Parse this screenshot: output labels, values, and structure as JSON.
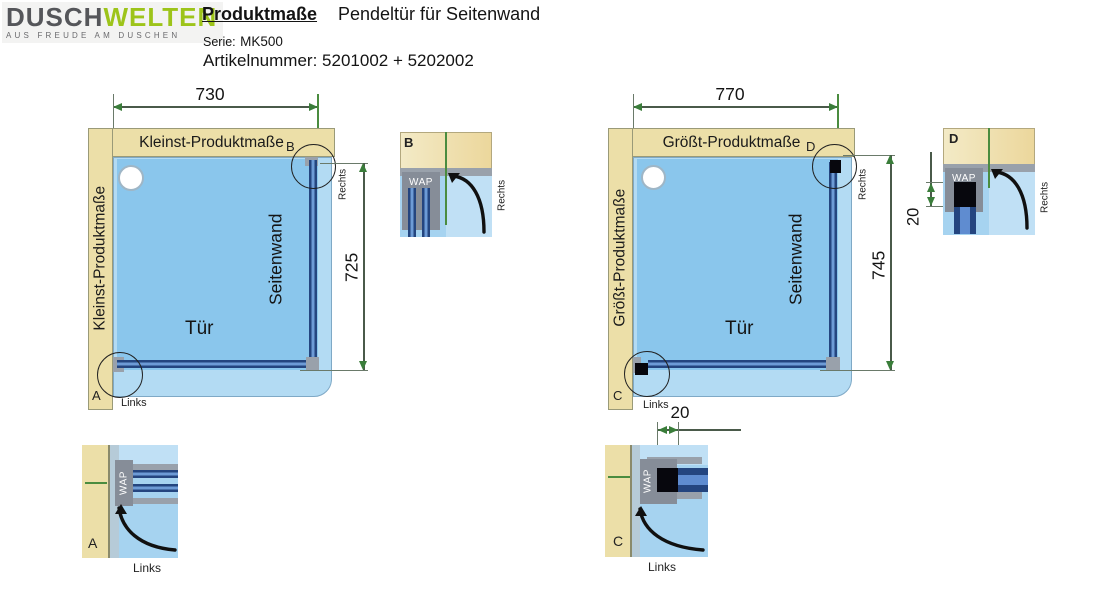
{
  "header": {
    "logo_dusch": "DUSCH",
    "logo_welten": "WELTEN",
    "logo_tagline": "AUS FREUDE AM DUSCHEN",
    "title": "Produktmaße",
    "subtitle": "Pendeltür für Seitenwand",
    "serie_label": "Serie:",
    "serie_value": "MK500",
    "artikel_label": "Artikelnummer:",
    "artikel_value": "5201002 + 5202002"
  },
  "diagrams": {
    "kleinst": {
      "top_label": "Kleinst-Produktmaße",
      "side_label": "Kleinst-Produktmaße",
      "width": "730",
      "height": "725",
      "door": "Tür",
      "sidewall": "Seitenwand",
      "marker_top": "B",
      "marker_bottom": "A",
      "links": "Links",
      "rechts": "Rechts"
    },
    "groesst": {
      "top_label": "Größt-Produktmaße",
      "side_label": "Größt-Produktmaße",
      "width": "770",
      "height": "745",
      "door": "Tür",
      "sidewall": "Seitenwand",
      "marker_top": "D",
      "marker_bottom": "C",
      "links": "Links",
      "rechts": "Rechts"
    }
  },
  "details": {
    "b": {
      "marker": "B",
      "wap": "WAP",
      "side": "Rechts"
    },
    "a": {
      "marker": "A",
      "wap": "WAP",
      "side": "Links"
    },
    "d": {
      "marker": "D",
      "wap": "WAP",
      "side": "Rechts",
      "gap": "20"
    },
    "c": {
      "marker": "C",
      "wap": "WAP",
      "side": "Links",
      "gap": "20"
    }
  },
  "colors": {
    "brand_green": "#9dc41a",
    "logo_gray": "#55565a",
    "wall_beige": "#ecdfa8",
    "tray_blue": "#8ac6ec",
    "tray_rim": "#b3dbf3",
    "glass_blue": "#24457f",
    "profile_gray": "#99a1ab",
    "dim_arrow_green": "#3a7d3a",
    "gap_black": "#07070d"
  }
}
